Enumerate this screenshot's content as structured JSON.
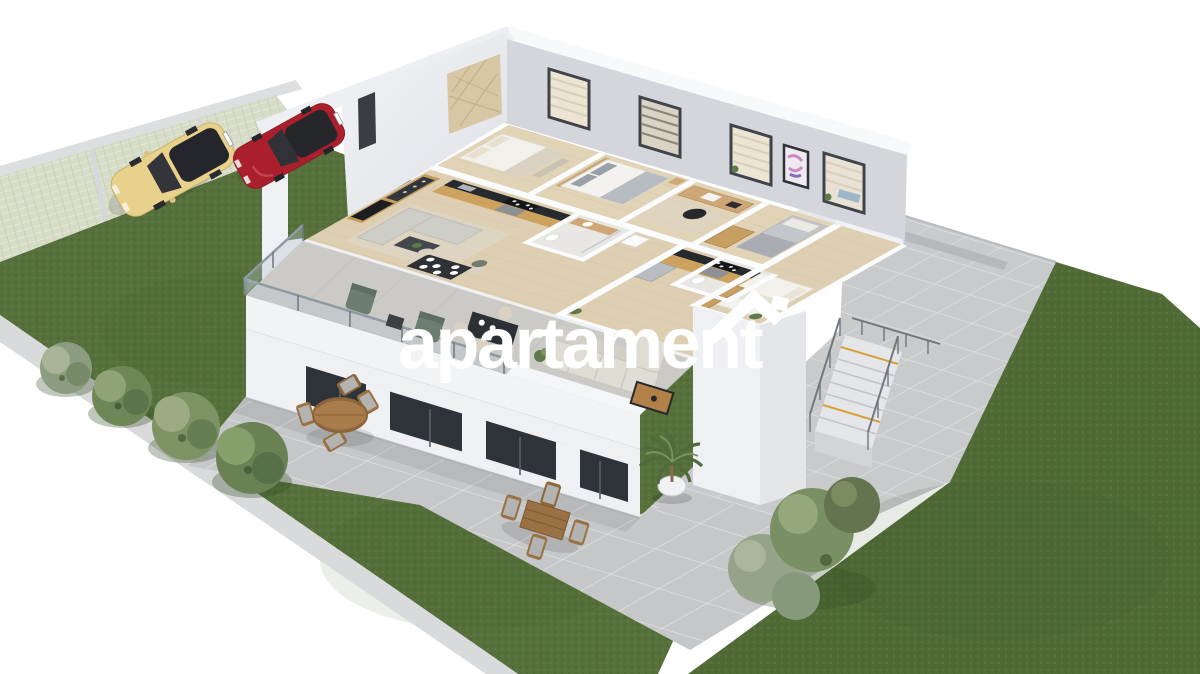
{
  "canvas": {
    "width": 1200,
    "height": 674,
    "background": "#ffffff"
  },
  "watermark": {
    "text": "apartament",
    "color": "#ffffff",
    "logo": "house-roof-icon"
  },
  "scene": {
    "kind": "isometric 3D cutaway render of a two-storey apartment building on a landscaped plot",
    "palette": {
      "grass": "#57713c",
      "grass_dark": "#4c6533",
      "grass_right": "#516b37",
      "paver_strip": "#d7dcc9",
      "curb": "#d9dadc",
      "pavement": "#c8cacc",
      "terrace_tile": "#c6c7c9",
      "building_white": "#f2f3f5",
      "wall_grey": "#d5d6db",
      "wall_shade": "#e7e9ed",
      "wood_floor": "#decfb2",
      "wood_cabinet": "#cda25f",
      "counter_dark": "#26292e",
      "glazing_dark": "#2e333a",
      "sofa_grey": "#cfcdc7",
      "sofa_beige": "#dfdcd3",
      "chair_green": "#6d7e71",
      "outdoor_wood": "#9a7143",
      "car_yellow": "#e8d28b",
      "car_red": "#ab1f2c",
      "stair_accent": "#d9a13c",
      "plant_green": "#5f7a4a",
      "glass_railing": "#b9c7d2"
    },
    "site": {
      "parking": {
        "surface": "grass-grid pavers",
        "stalls": 3,
        "occupied": 2
      },
      "lawns": [
        "left lawn with bush row",
        "right lawn with bush cluster",
        "bottom lawn wedge"
      ],
      "paths": [
        "rear paved apron",
        "ground-floor terrace"
      ]
    },
    "vehicles": [
      {
        "name": "yellow-hatchback",
        "color": "#e8d28b"
      },
      {
        "name": "red-hatchback",
        "color": "#ab1f2c"
      }
    ],
    "vegetation": {
      "left_bushes": 4,
      "right_bushes": 4,
      "balcony_palm": 1
    },
    "building": {
      "storeys": 2,
      "view": "roof removed - furnished upper floor visible",
      "apartments": 2,
      "rooms": [
        "bedroom",
        "bedroom",
        "home-office",
        "single-bedroom",
        "bathroom",
        "bathroom",
        "hallway",
        "kitchen",
        "living-room",
        "dining-area",
        "kitchen",
        "living-room",
        "dining-area",
        "wing-bedroom"
      ],
      "rear_windows": 4,
      "wall_art": 1,
      "balcony": {
        "railing": "glass",
        "parapet": "white",
        "furniture": [
          "green armchair",
          "green armchair",
          "side table",
          "outdoor dining set",
          "beige sectional sofa",
          "wooden coffee table",
          "potted palm"
        ]
      },
      "exterior_stairs": {
        "flights": 1,
        "railing": "steel",
        "edge_accent": "#d9a13c"
      },
      "terrace_furniture": [
        "round wooden dining set",
        "square wooden dining set"
      ]
    }
  }
}
